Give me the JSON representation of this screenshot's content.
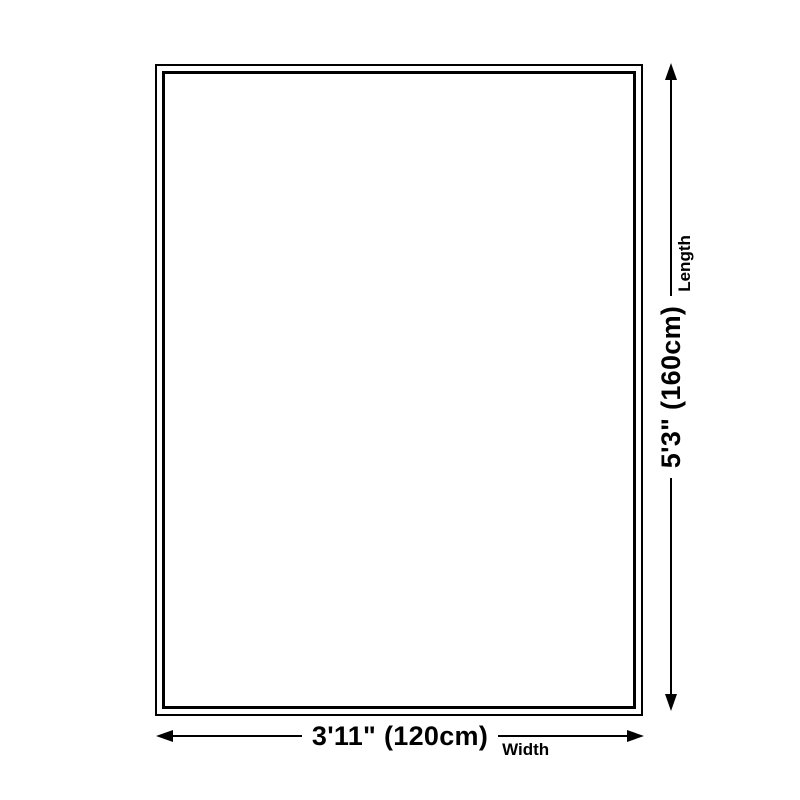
{
  "diagram": {
    "type": "product-size-diagram",
    "dimensions": {
      "width": {
        "value": "3'11\" (120cm)",
        "label": "Width"
      },
      "length": {
        "value": "5'3\" (160cm)",
        "label": "Length"
      }
    }
  },
  "colors": {
    "background": "#ffffff",
    "line": "#000000",
    "text": "#000000"
  },
  "icons": {
    "arrowheads": [
      "arrow-left-icon",
      "arrow-right-icon",
      "arrow-up-icon",
      "arrow-down-icon"
    ]
  }
}
